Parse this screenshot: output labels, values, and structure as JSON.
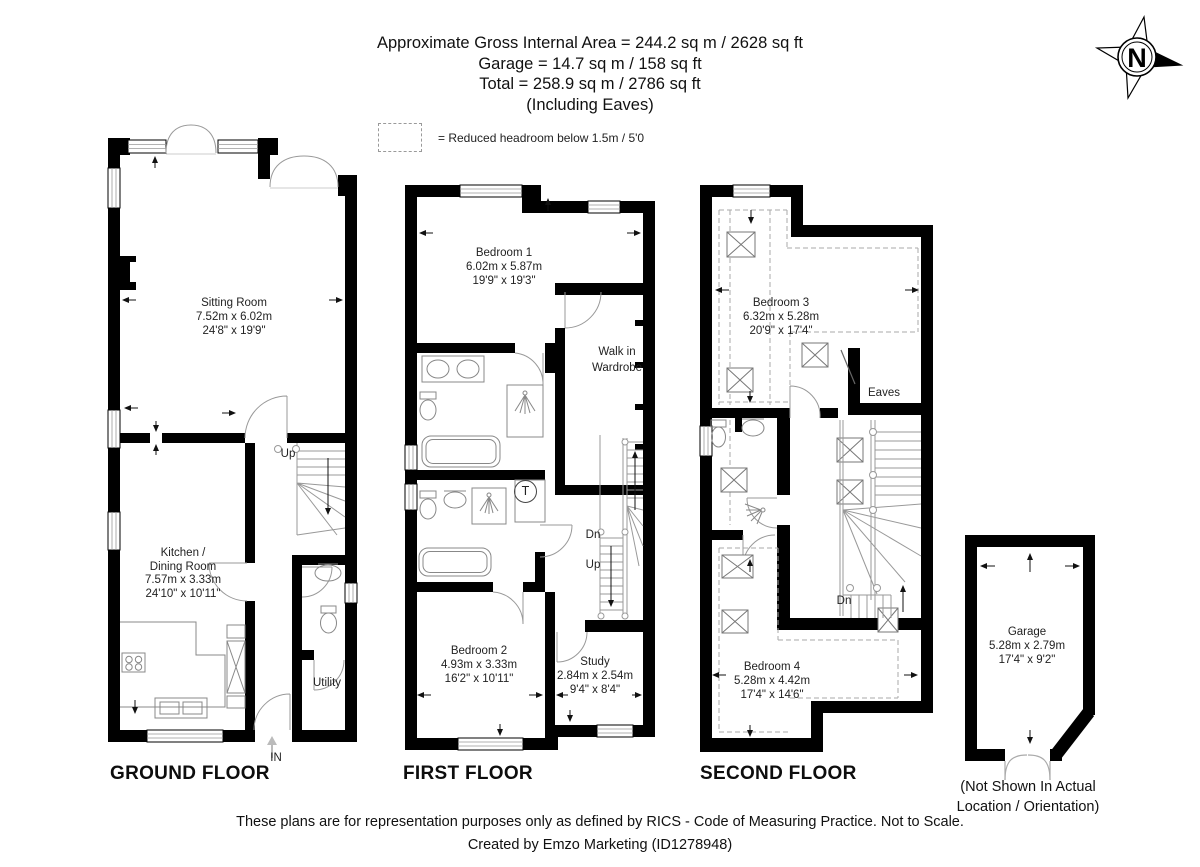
{
  "header": {
    "line1": "Approximate Gross Internal Area = 244.2 sq m / 2628 sq ft",
    "line2": "Garage = 14.7 sq m / 158 sq ft",
    "line3": "Total = 258.9 sq m / 2786 sq ft",
    "line4": "(Including Eaves)"
  },
  "legend": {
    "text": "= Reduced headroom below 1.5m / 5'0"
  },
  "compass": {
    "letter": "N"
  },
  "floors": {
    "ground": {
      "title": "GROUND FLOOR",
      "up": "Up",
      "entrance": "IN",
      "rooms": {
        "sitting": {
          "name": "Sitting Room",
          "metric": "7.52m x 6.02m",
          "imperial": "24'8\" x 19'9\""
        },
        "kitchen": {
          "line1": "Kitchen /",
          "line2": "Dining Room",
          "metric": "7.57m x 3.33m",
          "imperial": "24'10\" x 10'11\""
        },
        "utility": {
          "name": "Utility"
        }
      }
    },
    "first": {
      "title": "FIRST FLOOR",
      "dn": "Dn",
      "up": "Up",
      "tank": "T",
      "rooms": {
        "bedroom1": {
          "name": "Bedroom 1",
          "metric": "6.02m x 5.87m",
          "imperial": "19'9\" x 19'3\""
        },
        "walk_in": {
          "line1": "Walk in",
          "line2": "Wardrobe"
        },
        "bedroom2": {
          "name": "Bedroom 2",
          "metric": "4.93m x 3.33m",
          "imperial": "16'2\" x 10'11\""
        },
        "study": {
          "name": "Study",
          "metric": "2.84m x 2.54m",
          "imperial": "9'4\" x 8'4\""
        }
      }
    },
    "second": {
      "title": "SECOND FLOOR",
      "dn": "Dn",
      "rooms": {
        "bedroom3": {
          "name": "Bedroom 3",
          "metric": "6.32m x 5.28m",
          "imperial": "20'9\" x 17'4\""
        },
        "bedroom4": {
          "name": "Bedroom 4",
          "metric": "5.28m x 4.42m",
          "imperial": "17'4\" x 14'6\""
        },
        "eaves": {
          "name": "Eaves"
        }
      }
    },
    "garage": {
      "room": {
        "name": "Garage",
        "metric": "5.28m x 2.79m",
        "imperial": "17'4\" x 9'2\""
      },
      "note1": "(Not Shown In Actual",
      "note2": "Location / Orientation)"
    }
  },
  "footer": {
    "line1": "These plans are for representation purposes only as defined by RICS - Code of Measuring Practice. Not to Scale.",
    "line2": "Created by Emzo Marketing (ID1278948)"
  }
}
